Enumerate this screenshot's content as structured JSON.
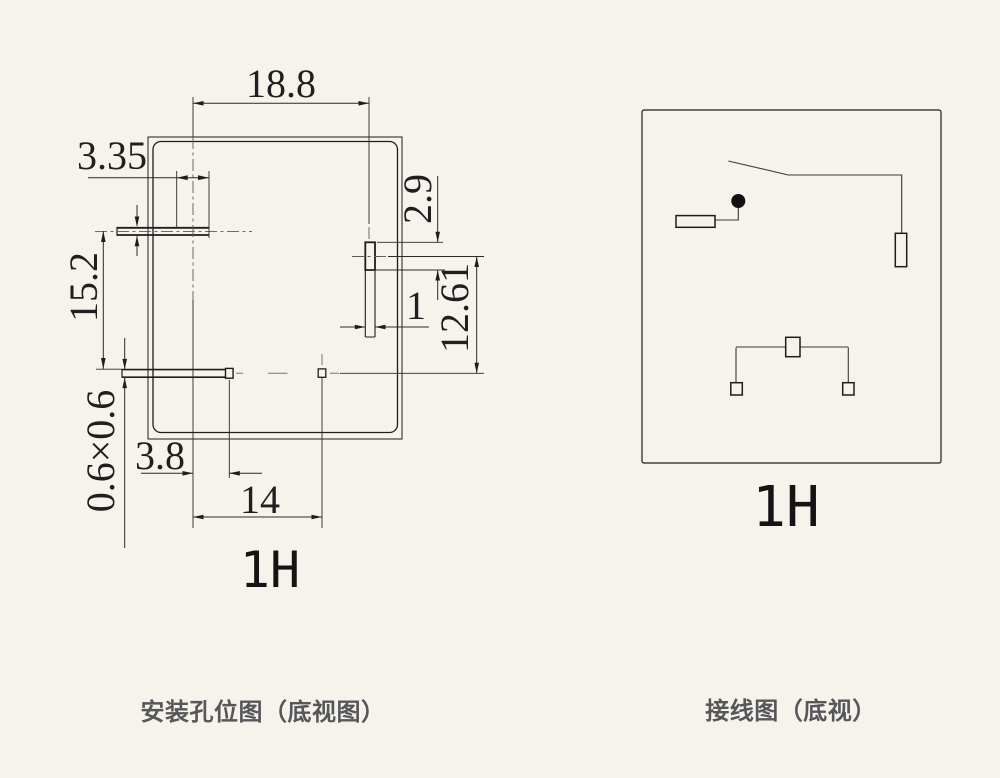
{
  "page": {
    "background_color": "#f6f3ed",
    "ink_color": "#1d1d1d",
    "caption_color": "#57575a"
  },
  "left_drawing": {
    "label": "1H",
    "caption": "安装孔位图（底视图）",
    "dimensions": {
      "top_width": "18.8",
      "top_slot_length": "3.35",
      "left_vertical_pitch": "15.2",
      "slot_cross_section": "0.6×0.6",
      "right_hole_height": "2.9",
      "right_hole_width": "1",
      "right_vertical_pitch": "12.61",
      "bottom_offset": "3.8",
      "bottom_pitch": "14"
    }
  },
  "right_drawing": {
    "label": "1H",
    "caption": "接线图（底视）"
  }
}
